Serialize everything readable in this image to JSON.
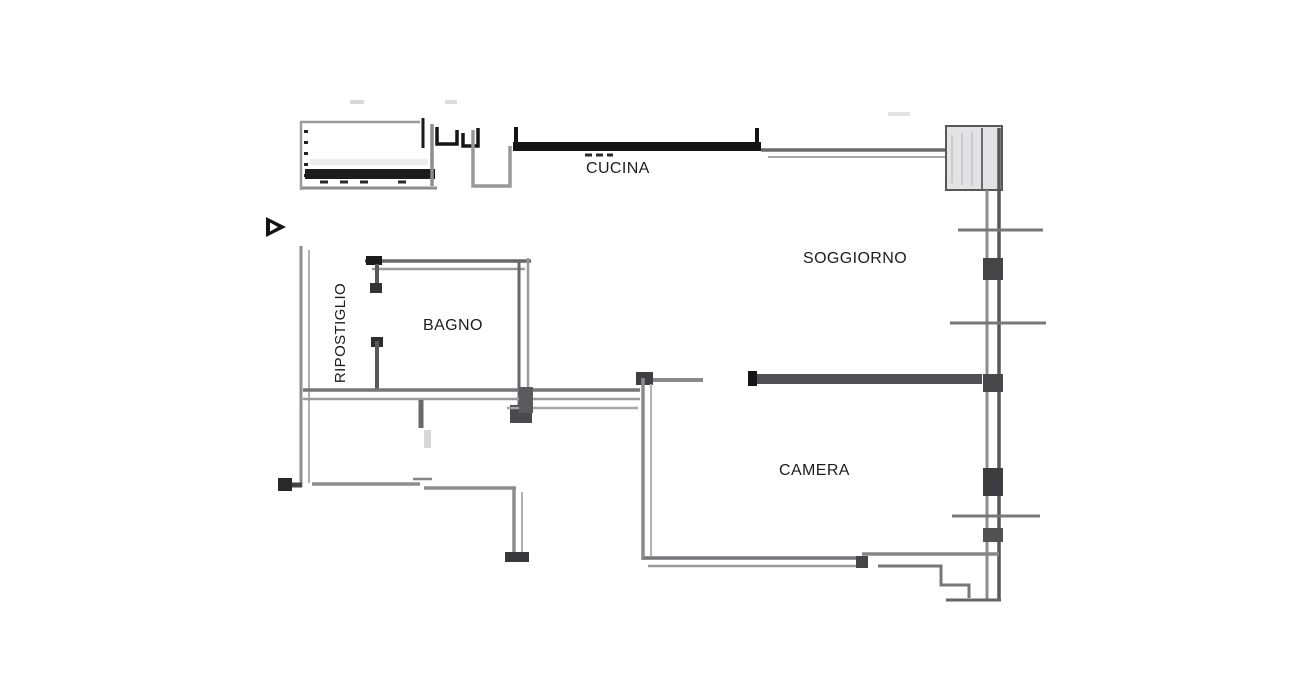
{
  "plan": {
    "kind": "apartment-floor-plan",
    "rooms": [
      {
        "id": "cucina",
        "label": "CUCINA"
      },
      {
        "id": "soggiorno",
        "label": "SOGGIORNO"
      },
      {
        "id": "bagno",
        "label": "BAGNO"
      },
      {
        "id": "ripostiglio",
        "label": "RIPOSTIGLIO"
      },
      {
        "id": "camera",
        "label": "CAMERA"
      }
    ],
    "icons": {
      "entry_arrow": "right-pointing-triangle"
    },
    "colors": {
      "background": "#ffffff",
      "wall_gray": "#8d8d90",
      "wall_gray_light": "#b0b0b3",
      "wall_gray_dark": "#58585c",
      "wall_black": "#141414",
      "divider_dark": "#505055",
      "pillar_fill": "#e3e3e5",
      "text": "#1d1d1f"
    }
  }
}
